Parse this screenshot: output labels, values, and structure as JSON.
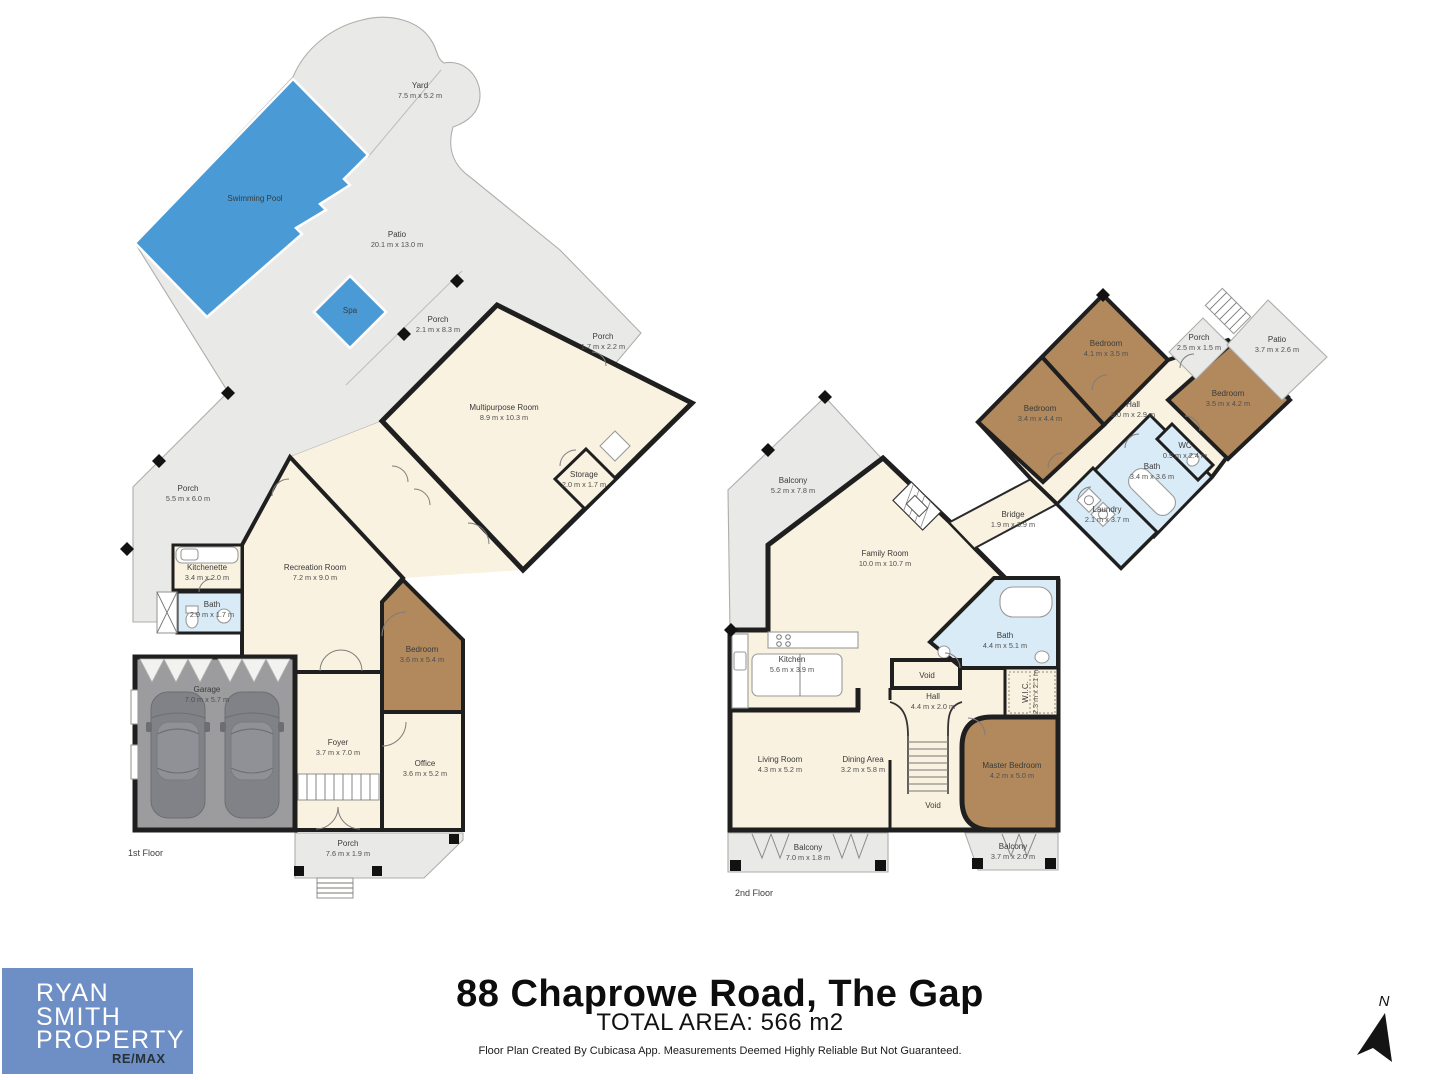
{
  "meta": {
    "address": "88 Chaprowe Road, The Gap",
    "total_area": "TOTAL AREA: 566 m2",
    "disclaimer": "Floor Plan Created By Cubicasa App. Measurements Deemed Highly Reliable But Not Guaranteed.",
    "north_label": "N"
  },
  "logo": {
    "line1": "RYAN",
    "line2": "SMITH",
    "line3": "PROPERTY",
    "brand": "RE/MAX"
  },
  "colors": {
    "outdoor": "#e9e9e7",
    "room": "#faf2e0",
    "bedroom": "#b1895c",
    "wet": "#d8ebf7",
    "pool": "#4a9bd5",
    "garage": "#9c9c9e",
    "wall": "#1f1f1f",
    "logo_bg": "#6e8ec6",
    "logo_brand": "#263238"
  },
  "floor1": {
    "label": "1st Floor",
    "rooms": {
      "yard": {
        "name": "Yard",
        "dims": "7.5 m x 5.2 m"
      },
      "pool": {
        "name": "Swimming Pool",
        "dims": ""
      },
      "patio": {
        "name": "Patio",
        "dims": "20.1 m x 13.0 m"
      },
      "spa": {
        "name": "Spa",
        "dims": ""
      },
      "porch_ne": {
        "name": "Porch",
        "dims": "2.1 m x 8.3 m"
      },
      "porch_small": {
        "name": "Porch",
        "dims": "1.7 m x 2.2 m"
      },
      "multipurpose": {
        "name": "Multipurpose Room",
        "dims": "8.9 m x 10.3 m"
      },
      "storage": {
        "name": "Storage",
        "dims": "2.0 m x 1.7 m"
      },
      "porch_w": {
        "name": "Porch",
        "dims": "5.5 m x 6.0 m"
      },
      "kitchenette": {
        "name": "Kitchenette",
        "dims": "3.4 m x 2.0 m"
      },
      "bath": {
        "name": "Bath",
        "dims": "2.9 m x 1.7 m"
      },
      "recreation": {
        "name": "Recreation Room",
        "dims": "7.2 m x 9.0 m"
      },
      "bedroom": {
        "name": "Bedroom",
        "dims": "3.6 m x 5.4 m"
      },
      "garage": {
        "name": "Garage",
        "dims": "7.0 m x 5.7 m"
      },
      "foyer": {
        "name": "Foyer",
        "dims": "3.7 m x 7.0 m"
      },
      "office": {
        "name": "Office",
        "dims": "3.6 m x 5.2 m"
      },
      "porch_s": {
        "name": "Porch",
        "dims": "7.6 m x 1.9 m"
      }
    }
  },
  "floor2": {
    "label": "2nd Floor",
    "rooms": {
      "balcony_nw": {
        "name": "Balcony",
        "dims": "5.2 m x 7.8 m"
      },
      "family": {
        "name": "Family Room",
        "dims": "10.0 m x 10.7 m"
      },
      "bridge": {
        "name": "Bridge",
        "dims": "1.9 m x 3.9 m"
      },
      "bedroom_n": {
        "name": "Bedroom",
        "dims": "4.1 m x 3.5 m"
      },
      "bedroom_w": {
        "name": "Bedroom",
        "dims": "3.4 m x 4.4 m"
      },
      "bedroom_e": {
        "name": "Bedroom",
        "dims": "3.5 m x 4.2 m"
      },
      "hall_upper": {
        "name": "Hall",
        "dims": "8.0 m x 2.9 m"
      },
      "porch": {
        "name": "Porch",
        "dims": "2.5 m x 1.5 m"
      },
      "patio": {
        "name": "Patio",
        "dims": "3.7 m x 2.6 m"
      },
      "wc": {
        "name": "WC",
        "dims": "0.9 m x 2.4 m"
      },
      "bath_upper": {
        "name": "Bath",
        "dims": "3.4 m x 3.6 m"
      },
      "laundry": {
        "name": "Laundry",
        "dims": "2.1 m x 3.7 m"
      },
      "bath": {
        "name": "Bath",
        "dims": "4.4 m x 5.1 m"
      },
      "kitchen": {
        "name": "Kitchen",
        "dims": "5.6 m x 3.9 m"
      },
      "void_top": {
        "name": "Void",
        "dims": ""
      },
      "hall": {
        "name": "Hall",
        "dims": "4.4 m x 2.0 m"
      },
      "wic": {
        "name": "W.I.C.",
        "dims": "2.3 m x 2.1 m"
      },
      "living": {
        "name": "Living Room",
        "dims": "4.3 m x 5.2 m"
      },
      "dining": {
        "name": "Dining Area",
        "dims": "3.2 m x 5.8 m"
      },
      "master": {
        "name": "Master Bedroom",
        "dims": "4.2 m x 5.0 m"
      },
      "void_bottom": {
        "name": "Void",
        "dims": ""
      },
      "balcony_s": {
        "name": "Balcony",
        "dims": "7.0 m x 1.8 m"
      },
      "balcony_se": {
        "name": "Balcony",
        "dims": "3.7 m x 2.0 m"
      }
    }
  }
}
